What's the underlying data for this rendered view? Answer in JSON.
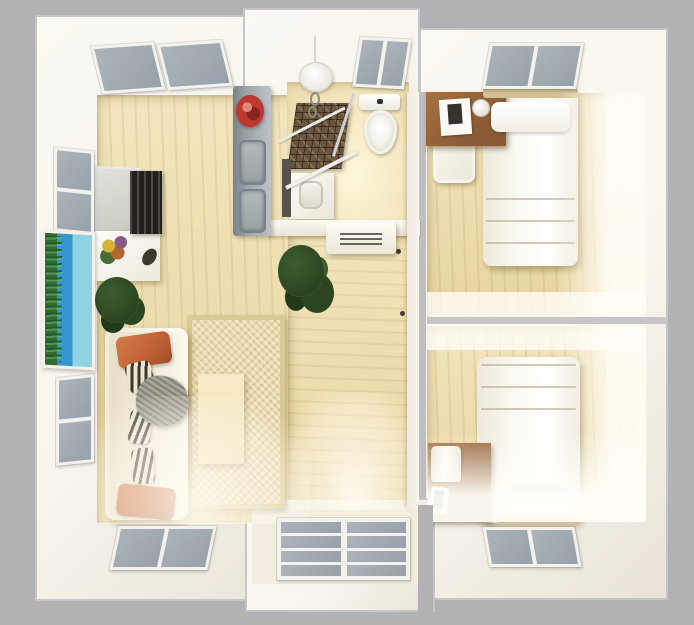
{
  "meta": {
    "kind": "3d-floor-plan-render",
    "view": "top-down",
    "rooms": [
      {
        "id": "living-room",
        "features": [
          "skylight-windows",
          "wall-windows",
          "wall-aquarium",
          "tv-cabinet",
          "sofa",
          "area-rug",
          "coffee-table",
          "potted-plant"
        ]
      },
      {
        "id": "kitchenette",
        "features": [
          "counter",
          "double-sink",
          "red-flower-bowl"
        ]
      },
      {
        "id": "bathroom",
        "features": [
          "pendant-lamp",
          "window",
          "toilet",
          "mosaic-shower",
          "glass-partition",
          "vanity-sink"
        ]
      },
      {
        "id": "hallway",
        "features": [
          "vent-cabinet",
          "potted-plant",
          "door-handles"
        ]
      },
      {
        "id": "bedroom-top",
        "features": [
          "window",
          "single-bed",
          "pillow",
          "desk",
          "laptop",
          "desk-lamp",
          "chair"
        ]
      },
      {
        "id": "bedroom-bottom",
        "features": [
          "single-bed",
          "pillow",
          "headboard",
          "nightstand",
          "table-lamp",
          "phone",
          "window"
        ]
      },
      {
        "id": "entry-bay",
        "features": [
          "french-window-8-panes"
        ]
      }
    ]
  },
  "colors": {
    "bg": "#b2b2b4",
    "slab-border": "#c6c6c8",
    "wall": "#f8f5ee",
    "wall-shade": "#e9e3d6",
    "wood": "#eedca6",
    "wood-light": "#f6ebc4",
    "cream": "#f3ede0",
    "pane": "#97a0a8",
    "pane-light": "#adb4bb",
    "frame": "#f4f2ec",
    "counter": "#9ca4a8",
    "counter-edge": "#79828a",
    "accent-red": "#c0392e",
    "rug": "#e8d8ab",
    "rug-border": "#dbc993",
    "sofa": "#f0e8d4",
    "pillow-orange": "#c06135",
    "zebra-dark": "#3b362c",
    "zebra-light": "#ece5d2",
    "throw-gray": "#8e8a80",
    "plant-dark": "#2a451f",
    "plant-mid": "#3d5c30",
    "aqua-blue": "#3595cd",
    "aqua-light": "#8fd2e4",
    "aqua-green": "#2f6b33",
    "tile-brown": "#6a543c",
    "furn-wood": "#8a5a34",
    "furn-wood-light": "#a5713f",
    "bed-white": "#faf8f2",
    "lamp-white": "#f4f2ea",
    "screen-dark": "#23201c",
    "divider": "#c6c6c8",
    "headboard": "#d3c096",
    "glass": "#d9dbd6"
  }
}
